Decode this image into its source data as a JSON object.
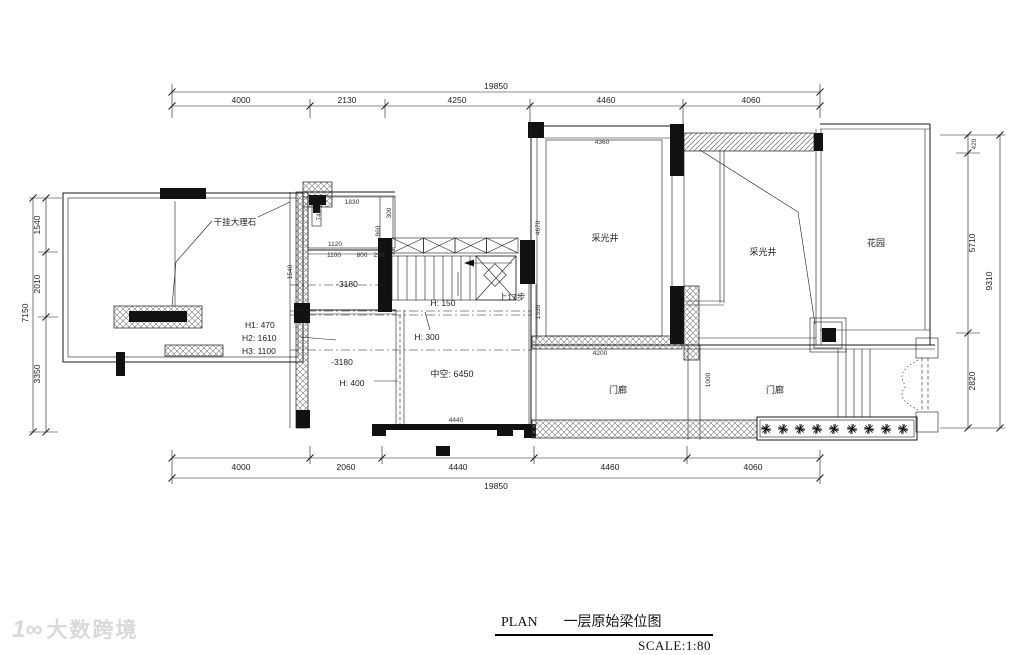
{
  "colors": {
    "line": "#1a1a1a",
    "hatch": "#777777",
    "watermark": "#d9d9d9",
    "paper": "#ffffff"
  },
  "title_block": {
    "plan_label": "PLAN",
    "drawing_name": "一层原始梁位图",
    "scale": "SCALE:1:80"
  },
  "watermark": {
    "logo": "1∞",
    "brand": "大数跨境"
  },
  "dims": {
    "top": {
      "total": "19850",
      "segments": [
        "4000",
        "2130",
        "4250",
        "4460",
        "4060"
      ]
    },
    "bottom": {
      "total": "19850",
      "segments": [
        "4000",
        "2060",
        "4440",
        "4460",
        "4060"
      ]
    },
    "left": {
      "total": "7150",
      "segments": [
        "1540",
        "2010",
        "3350"
      ]
    },
    "right": {
      "total": "9310",
      "segments": [
        "420",
        "5710",
        "2820"
      ]
    }
  },
  "rooms": {
    "light_well_1": "采光井",
    "light_well_2": "采光井",
    "garden": "花园",
    "porch_left": "门廊",
    "porch_right": "门廊",
    "void_label": "中空: 6450"
  },
  "annotations": {
    "marble": "干挂大理石",
    "h1": "H1: 470",
    "h2": "H2: 1610",
    "h3": "H3: 1100",
    "level_upper": "-3180",
    "level_lower": "-3180",
    "beam_h150": "H: 150",
    "beam_h300": "H: 300",
    "beam_h400": "H: 400",
    "stairs_up": "上17步"
  },
  "small_dims": {
    "d4360": "4360",
    "d4670": "4670",
    "d1330": "1330",
    "d4200": "4200",
    "d1000": "1000",
    "d4440": "4440",
    "d1540": "1540",
    "d1830": "1830",
    "d740": "740",
    "d1120": "1120",
    "d1100": "1100",
    "d800": "800",
    "d230": "230",
    "d300": "300",
    "d860": "860"
  }
}
